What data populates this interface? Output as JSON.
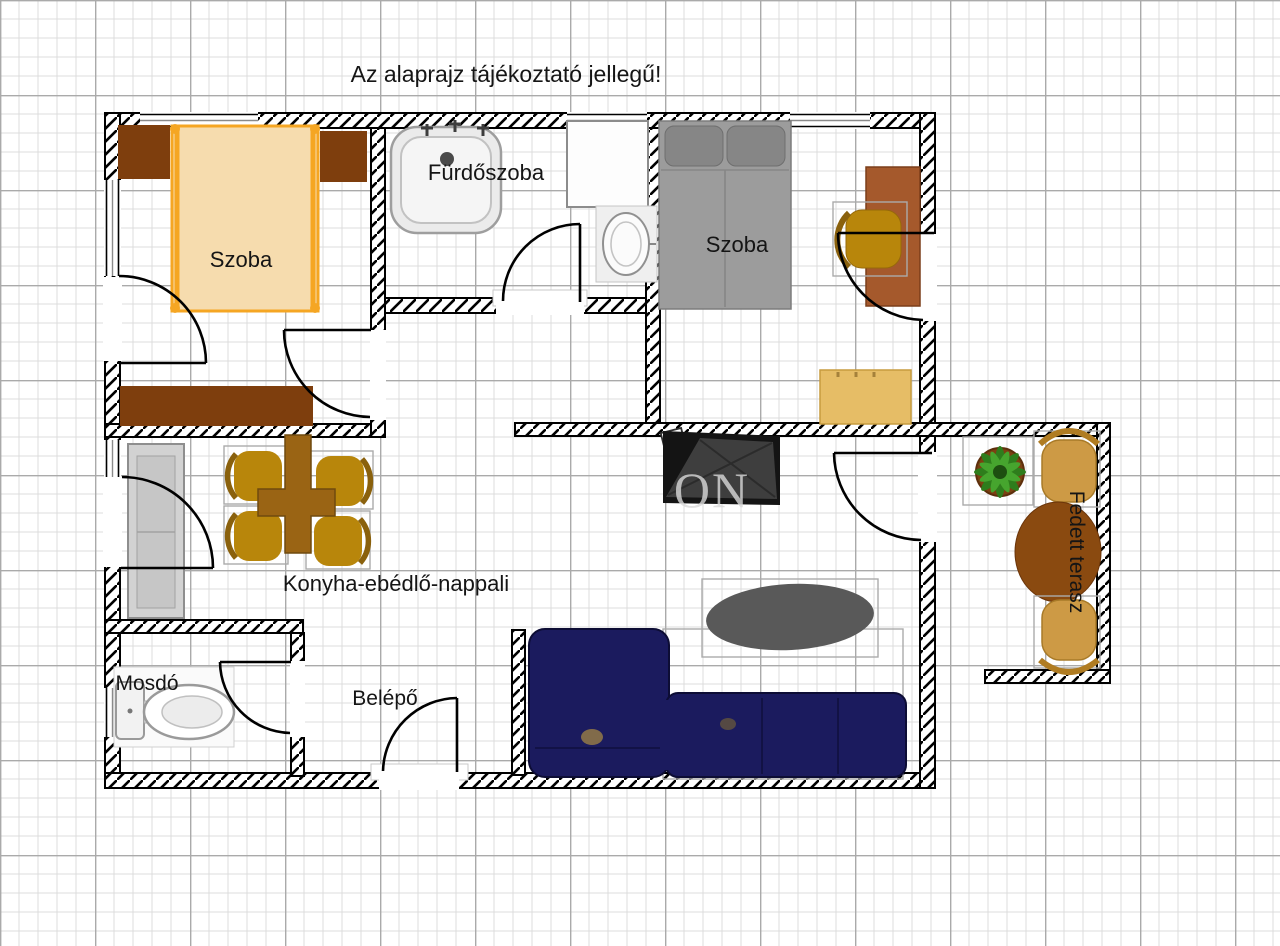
{
  "title": "Az alaprajz tájékoztató jellegű!",
  "labels": {
    "room1": "Szoba",
    "bathroom": "Fürdőszoba",
    "room2": "Szoba",
    "living": "Konyha-ebédlő-nappali",
    "wc": "Mosdó",
    "entry": "Belépő",
    "terrace": "Fedett terasz"
  },
  "watermark": "ON",
  "colors": {
    "wall_line": "#000000",
    "bed_frame_orange": "#f5a623",
    "bed_fill_tan": "#f6dcae",
    "wardrobe_brown": "#7e3e0d",
    "desk_brown": "#a5592c",
    "bed_gray": "#9c9c9c",
    "pillow_gray": "#868686",
    "chair_ochre": "#b8860b",
    "chair_back": "#8a610d",
    "dining_table_brown": "#9a6414",
    "dresser_tan": "#e6bd66",
    "sofa_navy": "#1b1b5e",
    "coffee_table_gray": "#595959",
    "terrace_chair_tan": "#cd9a45",
    "terrace_table_brown": "#8a4a10",
    "plant_green": "#2e7d1c",
    "plant_green_light": "#46a52e",
    "tv_black": "#141414",
    "fridge_gray": "#d2d2d2"
  }
}
